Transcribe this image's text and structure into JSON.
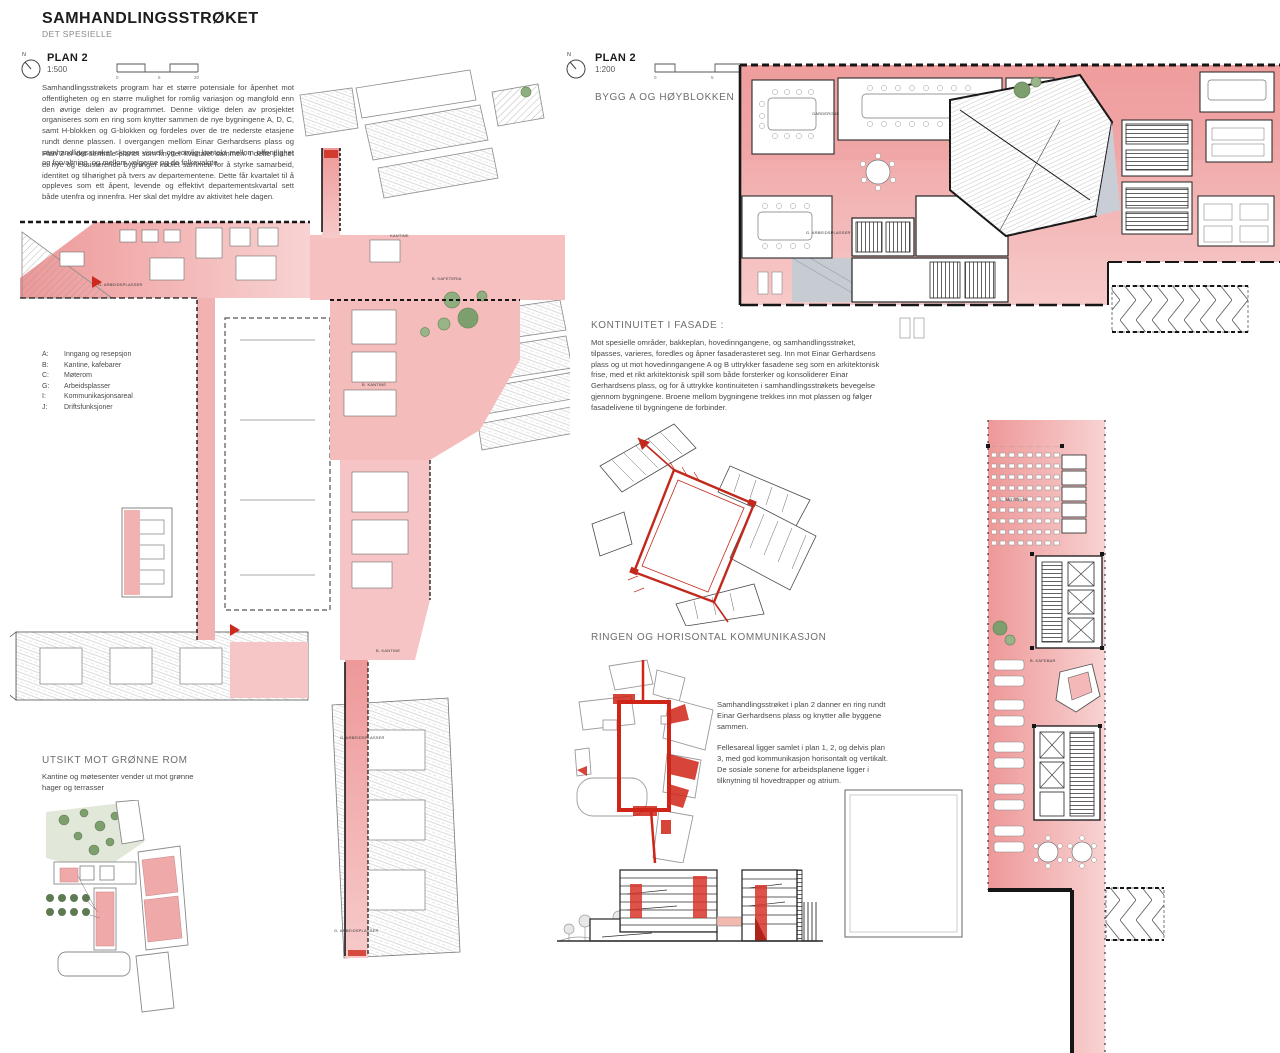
{
  "header": {
    "title": "SAMHANDLINGSSTRØKET",
    "subtitle": "DET SPESIELLE"
  },
  "colors": {
    "pink_zone": "#f2abab",
    "pink_light": "#f8cdcd",
    "accent_red": "#cd2a1d",
    "wall_black": "#161616",
    "tree_green": "#7d9e6d",
    "lawn_green": "#e1e8da"
  },
  "plan500": {
    "name": "PLAN 2",
    "scale": "1:500",
    "north": "N",
    "scalebar_ticks": [
      "0",
      "5",
      "20"
    ],
    "para1": "Samhandlingsstrøkets program har et større potensiale for åpenhet mot offentligheten og en større mulighet for romlig variasjon og mangfold enn den øvrige delen av programmet. Denne viktige delen av prosjektet organiseres som en ring som knytter sammen de nye bygningene A, D, C, samt H-blokken og G-blokken og fordeles over de tre nederste etasjene rundt denne plassen. I overgangen mellom Einar Gerhardsens plass og samhandlingsstrøket skapes visuell og romlig kontakt mellom offentlighet og forvaltning, og mellom velgerne og de folkevalgte.",
    "para2": "Plan 2 er det sentrale planet som knytter kvartalet sammen. I dette planet er nye og eksisterende bygninger koblet sammen for å styrke samarbeid, identitet og tilhørighet på tvers av departementene. Dette får kvartalet til å oppleves som ett åpent, levende og effektivt departementskvartal sett både utenfra og innenfra. Her skal det myldre av aktivitet hele dagen.",
    "legend": [
      {
        "key": "A:",
        "label": "Inngang og resepsjon"
      },
      {
        "key": "B:",
        "label": "Kantine, kafebarer"
      },
      {
        "key": "C:",
        "label": "Møterom"
      },
      {
        "key": "G:",
        "label": "Arbeidsplasser"
      },
      {
        "key": "I:",
        "label": "Kommunikasjonsareal"
      },
      {
        "key": "J:",
        "label": "Driftsfunksjoner"
      }
    ],
    "labels": {
      "arbeidsplasser_topleft": "G. ARBEIDSPLASSER",
      "kantine_top": "KANTINE",
      "kafeteria": "B. KAFETERIA",
      "kantine_mid": "B. KANTINE",
      "kantine_low": "B. KANTINE",
      "arbeidsplasser_mid": "G. ARBEIDSPLASSER",
      "arbeidsplasser_low": "G. ARBEIDSPLASSER"
    }
  },
  "plan200": {
    "name": "PLAN 2",
    "scale": "1:200",
    "north": "N",
    "building": "BYGG A OG HØYBLOKKEN",
    "scalebar_ticks": [
      "0",
      "5",
      "10"
    ],
    "labels": {
      "garderobe": "GARDEROBE",
      "arbeidsplasser": "G. ARBEIDSPLASSER",
      "moterom": "C. MØTEROM",
      "kafebar": "B. KAFEBAR"
    }
  },
  "sections": {
    "fasade": {
      "heading": "KONTINUITET I FASADE :",
      "body": "Mot spesielle områder, bakkeplan, hovedinngangene, og samhandlingsstrøket, tilpasses, varieres, foredles og åpner fasaderasteret seg. Inn mot Einar Gerhardsens plass og ut mot hovedinngangene A og B uttrykker fasadene seg som en arkitektonisk frise, med et rikt arkitektonisk spill som både forsterker og konsoliderer Einar Gerhardsens plass, og for å uttrykke kontinuiteten i samhandlingsstrøkets bevegelse gjennom bygningene. Broene mellom bygningene trekkes inn mot plassen og følger fasadelivene til bygningene de forbinder."
    },
    "ringen": {
      "heading": "RINGEN OG HORISONTAL KOMMUNIKASJON",
      "para1": "Samhandlingsstrøket i plan 2 danner en ring rundt Einar Gerhardsens plass og knytter alle byggene sammen.",
      "para2": "Fellesareal ligger samlet i plan 1, 2, og delvis plan 3, med god kommunikasjon horisontalt og vertikalt. De sosiale sonene for arbeidsplanene ligger i tilknytning til hovedtrapper og atrium."
    },
    "utsikt": {
      "heading": "UTSIKT MOT GRØNNE ROM",
      "body": "Kantine og møtesenter vender ut mot grønne hager og terrasser"
    }
  }
}
